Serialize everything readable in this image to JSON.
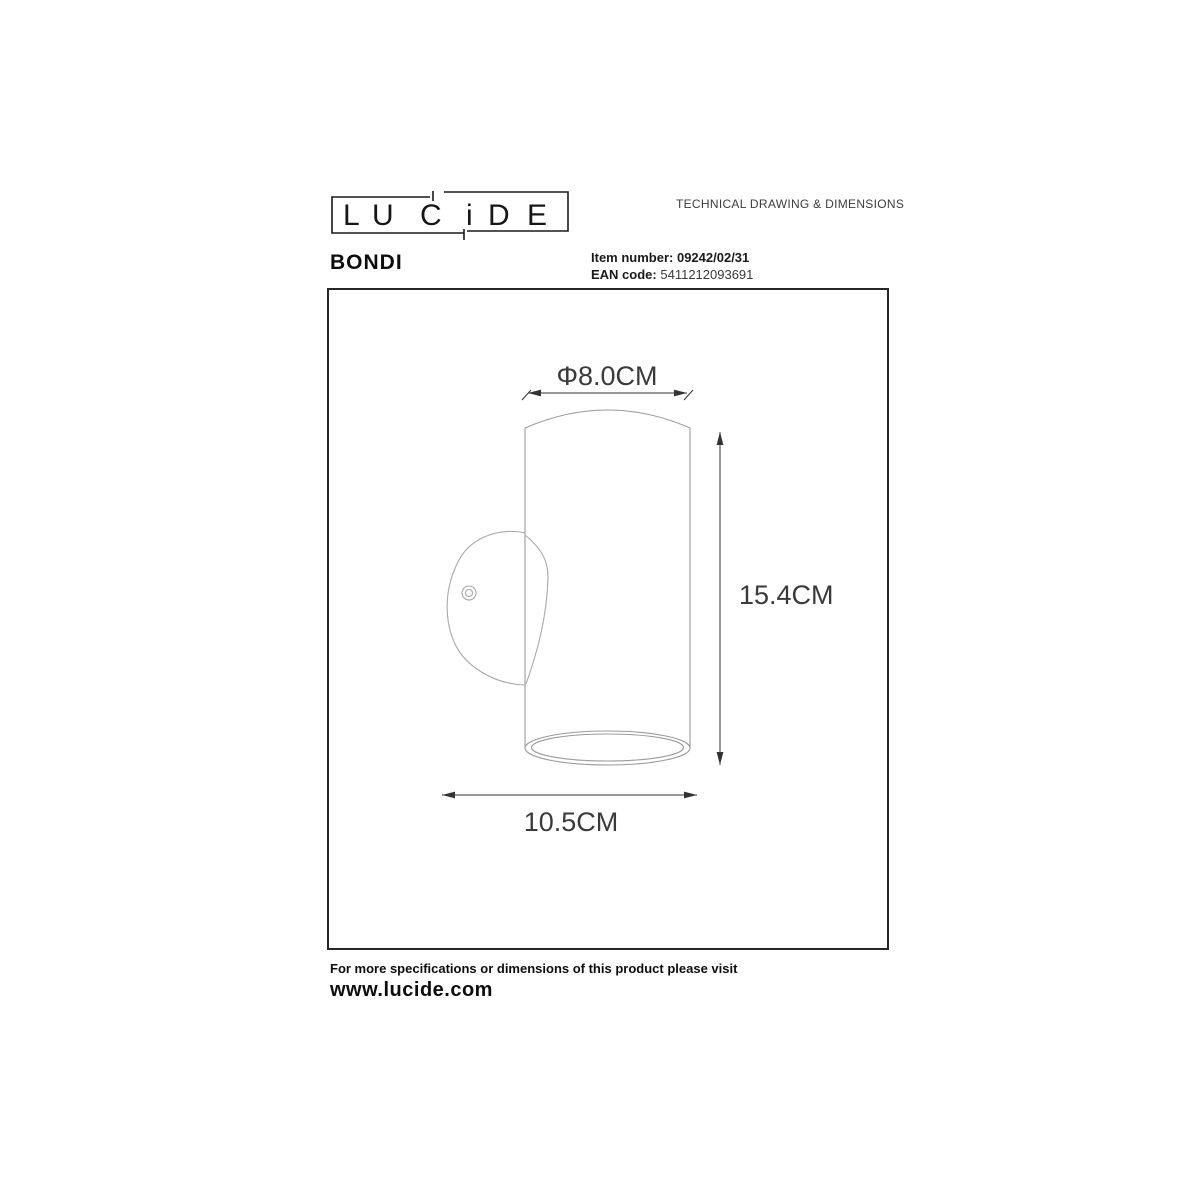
{
  "brand": {
    "letters": [
      "L",
      "U",
      "C",
      "i",
      "D",
      "E"
    ]
  },
  "header": {
    "doc_title": "TECHNICAL DRAWING & DIMENSIONS"
  },
  "product": {
    "name": "BONDI",
    "item_number_label": "Item number:",
    "item_number": "09242/02/31",
    "ean_label": "EAN code:",
    "ean": "5411212093691"
  },
  "drawing": {
    "dim_diameter": "Φ8.0CM",
    "dim_height": "15.4CM",
    "dim_depth": "10.5CM",
    "product_line_color": "#a8a8a8",
    "dimension_line_color": "#333333",
    "box_border_color": "#262626"
  },
  "footer": {
    "note": "For more specifications or dimensions of this product please visit",
    "website": "www.lucide.com"
  }
}
